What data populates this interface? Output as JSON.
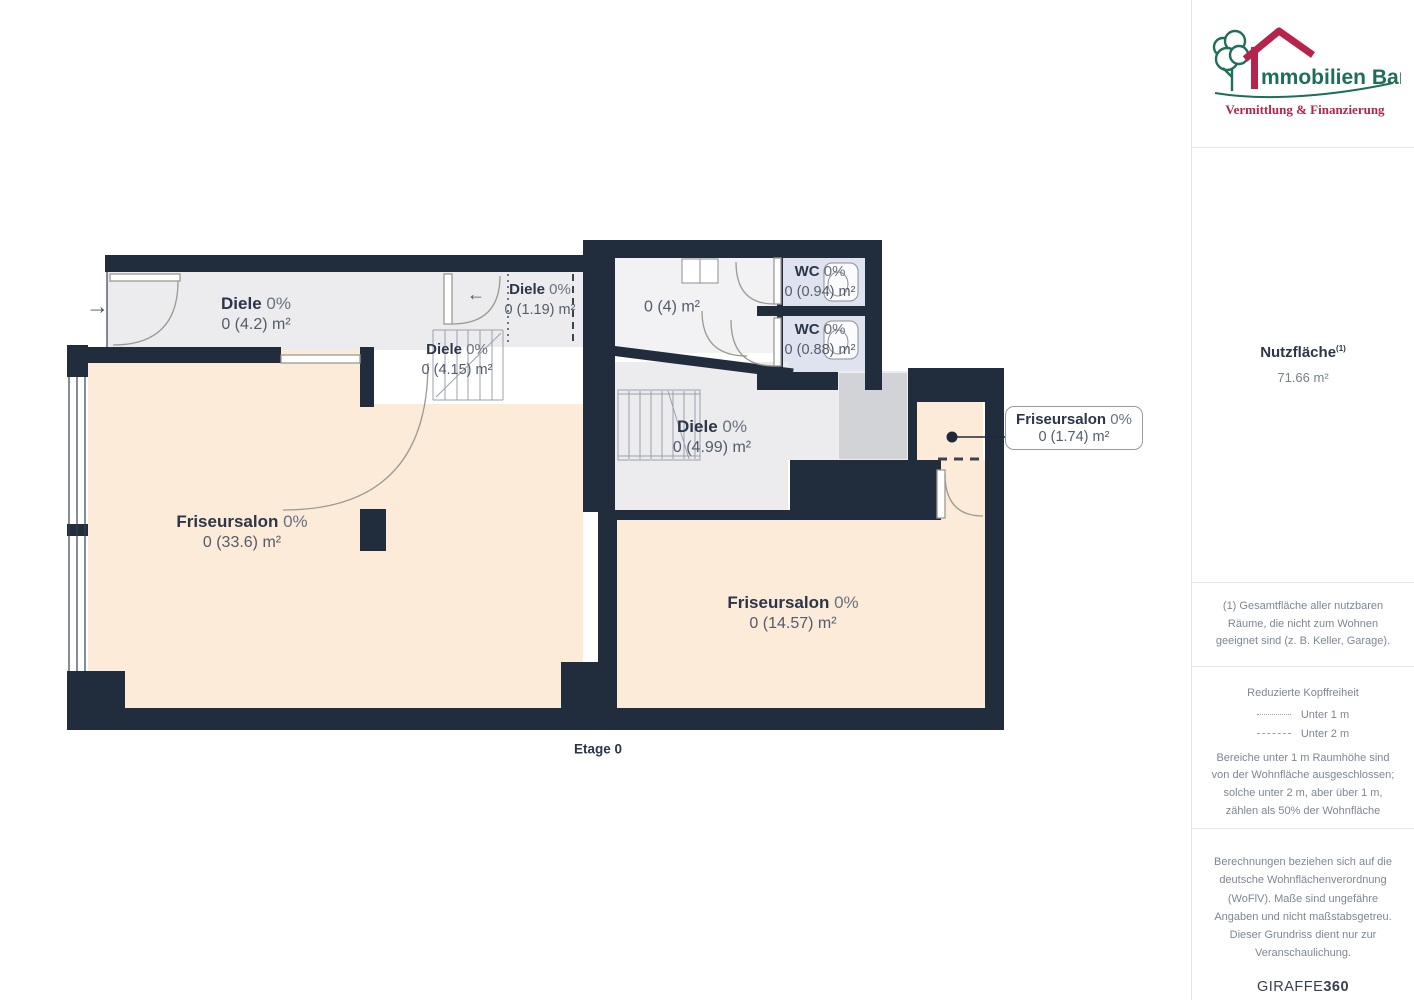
{
  "plan": {
    "floor_label": "Etage 0",
    "arrows": {
      "entry": "→",
      "inner": "←"
    },
    "rooms": [
      {
        "name": "Diele",
        "pct": "0%",
        "area": "0 (4.2) m²"
      },
      {
        "name": "Diele",
        "pct": "0%",
        "area": "0 (1.19) m²"
      },
      {
        "name": "Diele",
        "pct": "0%",
        "area": "0 (4.15) m²"
      },
      {
        "name": "",
        "pct": "",
        "area": "0 (4) m²"
      },
      {
        "name": "WC",
        "pct": "0%",
        "area": "0 (0.94) m²"
      },
      {
        "name": "WC",
        "pct": "0%",
        "area": "0 (0.88) m²"
      },
      {
        "name": "Diele",
        "pct": "0%",
        "area": "0 (4.99) m²"
      },
      {
        "name": "Friseursalon",
        "pct": "0%",
        "area": "0 (33.6) m²"
      },
      {
        "name": "Friseursalon",
        "pct": "0%",
        "area": "0 (14.57) m²"
      },
      {
        "name": "Friseursalon",
        "pct": "0%",
        "area": "0 (1.74) m²"
      }
    ],
    "colors": {
      "wall": "#212c3c",
      "floor_salon": "#fcebd9",
      "floor_hall": "#ececef",
      "floor_wc": "#dfe3f0",
      "floor_shaft": "#d2d3d6"
    }
  },
  "sidebar": {
    "logo": {
      "name_initial": "I",
      "name_rest": "mmobilien Bart",
      "tagline": "Vermittlung & Finanzierung",
      "green": "#1d6e5b",
      "red": "#b5244d"
    },
    "area_title": "Nutzfläche",
    "area_sup": "(1)",
    "area_value": "71.66 m²",
    "footnote": "(1) Gesamtfläche aller nutzbaren Räume, die nicht zum Wohnen geeignet sind (z. B. Keller, Garage).",
    "legend": {
      "title": "Reduzierte Kopffreiheit",
      "items": [
        {
          "style": "dotted",
          "label": "Unter 1 m"
        },
        {
          "style": "dashed",
          "label": "Unter 2 m"
        }
      ],
      "note": "Bereiche unter 1 m Raumhöhe sind von der Wohnfläche ausgeschlossen; solche unter 2 m, aber über 1 m, zählen als 50% der Wohnfläche"
    },
    "disclaimer": "Berechnungen beziehen sich auf die deutsche Wohnflächenverordnung (WoFlV). Maße sind ungefähre Angaben und nicht maßstabsgetreu. Dieser Grundriss dient nur zur Veranschaulichung.",
    "brand": {
      "name": "GIRAFFE",
      "suffix": "360"
    }
  }
}
